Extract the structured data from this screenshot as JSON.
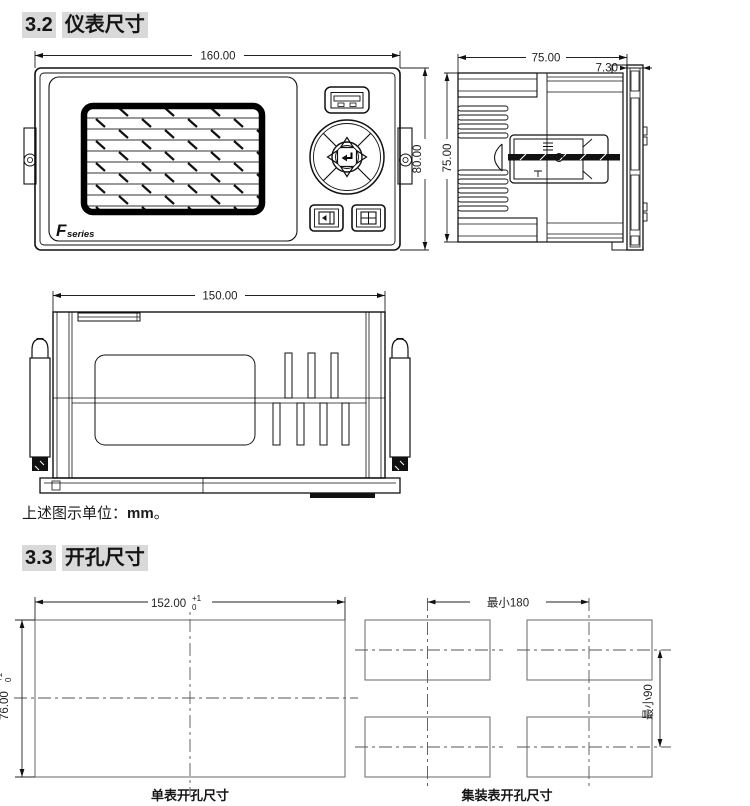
{
  "colors": {
    "line-dark": "#111111",
    "line-mid": "#555555",
    "line-light": "#757575",
    "dim": "#222222",
    "heading-bg": "#d9d9d9"
  },
  "headings": {
    "s32": {
      "num": "3.2",
      "title": "仪表尺寸"
    },
    "s33": {
      "num": "3.3",
      "title": "开孔尺寸"
    }
  },
  "note": {
    "prefix": "上述图示单位：",
    "unit": "mm",
    "suffix": "。"
  },
  "front_view": {
    "dim_width": "160.00",
    "dim_height": "80.00",
    "logo_f": "F",
    "logo_series": "series"
  },
  "side_view": {
    "dim_depth": "75.00",
    "dim_bezel": "7.30",
    "dim_height": "75.00"
  },
  "bottom_view": {
    "dim_width": "150.00"
  },
  "single_cutout": {
    "dim_width": "152.00",
    "dim_height": "76.00",
    "tol_plus": "+1",
    "tol_zero": "0",
    "caption": "单表开孔尺寸"
  },
  "multi_cutout": {
    "dim_min_width": "最小180",
    "dim_min_height": "最小90",
    "caption": "集装表开孔尺寸"
  }
}
